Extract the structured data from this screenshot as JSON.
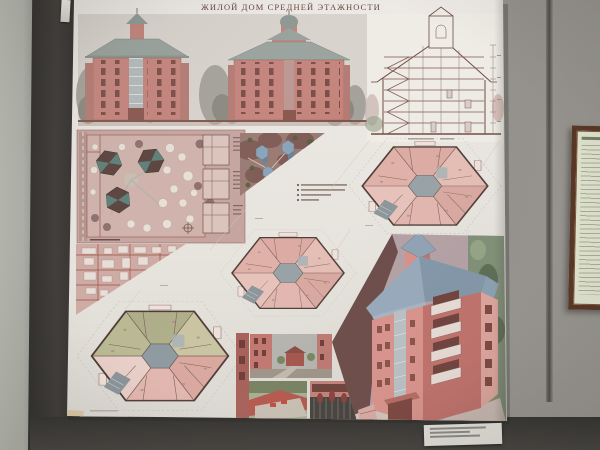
{
  "poster": {
    "title": "ЖИЛОЙ ДОМ СРЕДНЕЙ ЭТАЖНОСТИ"
  },
  "colors": {
    "wall_gray": "#8f8d8a",
    "wall_light_strip": "#b2b3aa",
    "wall_dark_panel": "#3e3b39",
    "wall_lower_dark": "#474443",
    "poster_paper": "#e9e6e0",
    "building_pink": "#c4847c",
    "elevation_roof_gray": "#98a19c",
    "axon_roof_blue": "#8fa2b4",
    "site_plan_pink": "#c6a5a0",
    "site_roof_teal": "#5b867e",
    "plan_room_pink": "#e2b6ae",
    "plan_room_olive": "#aeae89",
    "plan_core_gray": "#97a1a6",
    "drawing_line_red": "#94544a",
    "frame_wood": "#5a3828",
    "frame_paper": "#dfe2cf",
    "label_paper": "#dcdad3"
  }
}
